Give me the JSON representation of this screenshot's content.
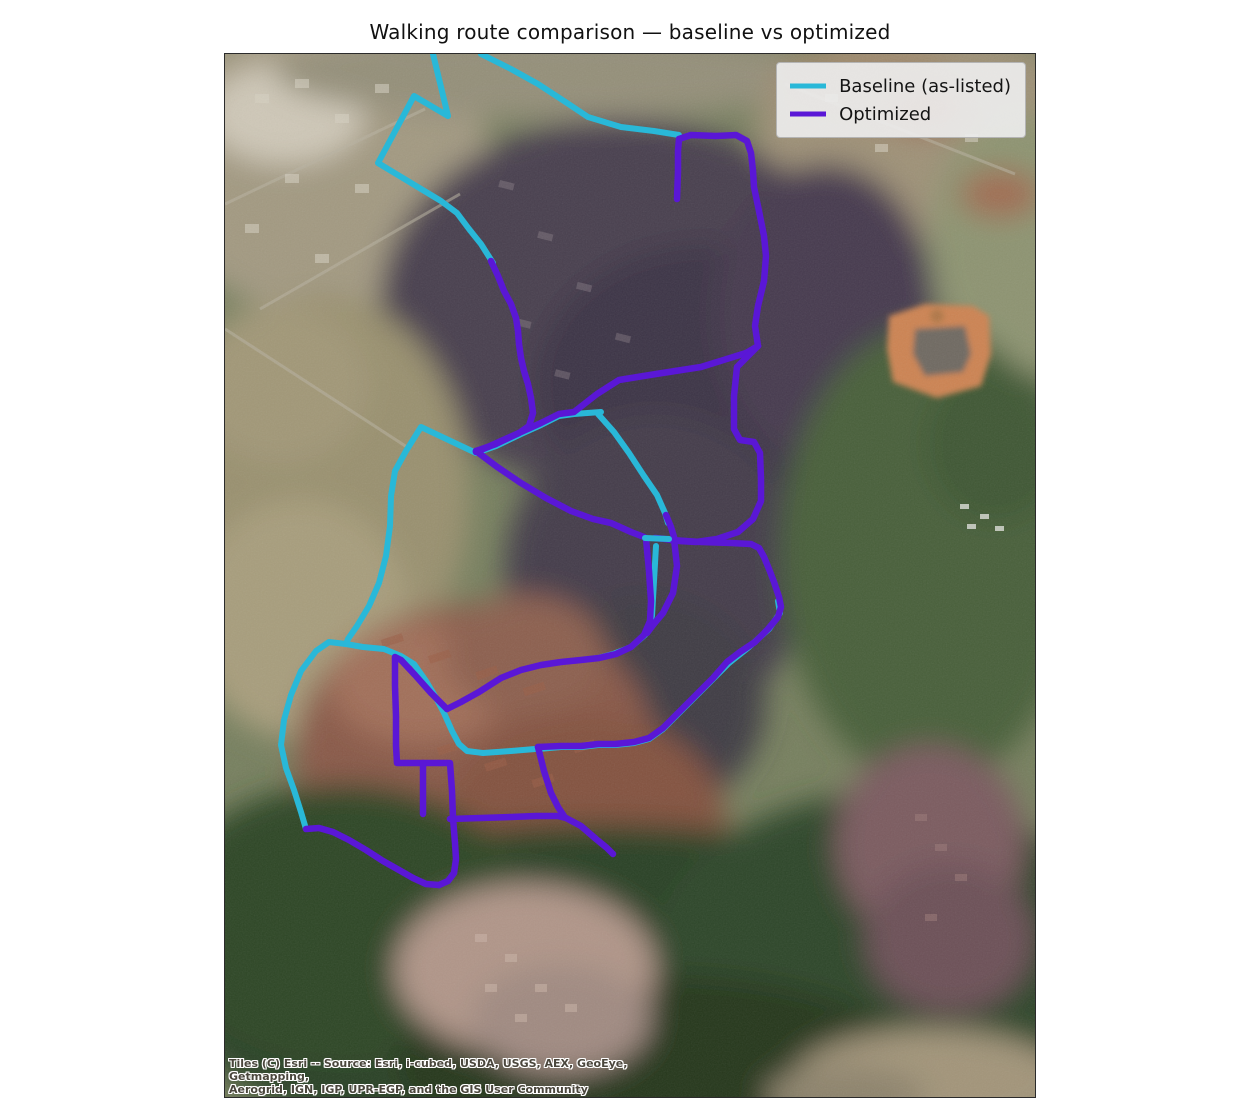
{
  "title": "Walking route comparison — baseline vs optimized",
  "legend": {
    "items": [
      {
        "label": "Baseline (as-listed)"
      },
      {
        "label": "Optimized"
      }
    ]
  },
  "map": {
    "attribution": {
      "line1": "Tiles (C) Esri -- Source: Esri, i-cubed, USDA, USGS, AEX, GeoEye, Getmapping,",
      "line2": "Aerogrid, IGN, IGP, UPR-EGP, and the GIS User Community"
    },
    "routes": {
      "baseline": {
        "name": "Baseline (as-listed)",
        "color": "#29b8d8",
        "segments": {
          "s1": "256,0 286,15 313,30 339,47 363,63 396,73 429,77 454,81",
          "s2": "208,0 223,62 189,42 153,109 216,147 232,159 244,175 256,190 268,209",
          "s3": "376,358 349,360 334,362 316,371 296,380 271,392 251,399 196,373 181,397 170,417 166,442 165,472 161,502 154,529 144,552 132,572 123,585 121,590 104,588 91,597 76,617 66,641 59,666 56,691 61,714 69,736 76,758 81,775",
          "s4": "121,590 138,593 159,595 176,602 189,610 201,627 210,642 219,659 227,677 234,690 242,697 258,699 286,697 310,695",
          "s5": "373,360 389,378 404,399 419,422 432,441 440,459 443,469",
          "s6": "420,484 444,485",
          "s7a": "431,492 429,527 427,562 420,581 406,593 388,600 373,604 356,606",
          "s7b": "553,547 555,559 544,575 524,593 504,609 488,625 472,641 455,658 438,675 424,685 409,689 390,691 373,691 356,693 336,693 313,695"
        }
      },
      "optimized": {
        "name": "Optimized",
        "color": "#5a17d6",
        "segments": {
          "q1": "452,145 453,117 453,97 454,85 466,81 491,82 511,81 522,87 526,99 528,117 529,133 534,157 539,182 541,202 539,227 533,252 530,272 533,292",
          "q2": "533,292 521,299 476,313 431,320 394,326 372,340 349,358 334,360 316,369 296,378 271,390 251,397",
          "q3": "533,292 522,303 512,313 509,342 509,375 515,386 529,388 535,399 536,425 536,447 528,465 513,478 492,485 471,488 454,487 440,485 430,484",
          "q4": "266,207 273,222 279,237 286,250 291,264 293,277 294,290 296,304 299,317 303,330 306,344 308,359 304,372 294,379 276,387 263,393 251,398",
          "q5": "251,397 271,412 296,429 321,444 346,457 368,465 386,469 406,478 419,483",
          "q6": "441,461 446,473 449,483",
          "q7": "446,486 476,488 506,489 526,490 534,494 539,503 544,515 549,528 554,543 556,553 553,563 543,575 530,588 515,598 502,608 488,624 472,640 455,657 438,674 424,684 409,688 390,690 373,690 356,692 336,692 313,693",
          "q8": "421,485 424,517 426,547 425,567 419,581 406,593 391,600 374,604 356,606 336,608 316,611 296,616 276,624 254,638 236,648 222,655",
          "q8b": "449,485 452,512 448,539 438,559 428,571 422,579",
          "q9": "222,655 206,639 190,621 176,606 170,603 170,632 171,662 171,692 172,709 188,709 206,709 225,709 227,737 228,764 230,789 231,805 229,819 223,827 214,831",
          "q10": "81,775 94,774 108,778 124,786 141,796 158,807 174,816 188,824 201,830 214,831",
          "q11": "198,709 198,760",
          "q12": "225,765 256,764 286,763 311,762 333,762 341,764 356,772 371,785 382,794 388,800",
          "q13": "313,693 319,717 326,739 333,753 339,762"
        }
      }
    }
  }
}
